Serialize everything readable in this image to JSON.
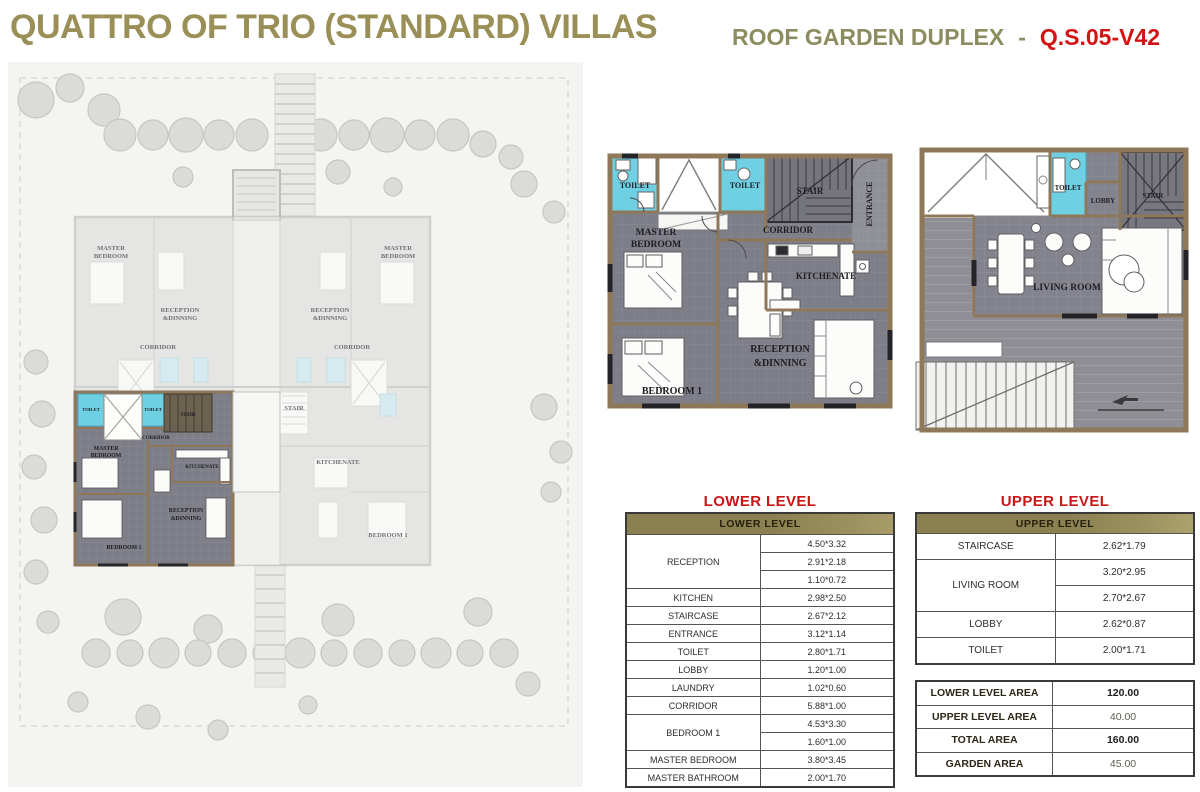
{
  "header": {
    "title": "QUATTRO OF TRIO (STANDARD) VILLAS",
    "subtitle": "ROOF GARDEN DUPLEX",
    "separator": "-",
    "unit_code": "Q.S.05-V42"
  },
  "colors": {
    "title_gold": "#9A8F57",
    "subtitle_olive": "#8C8C60",
    "code_red": "#D21414",
    "section_title_red": "#C91616",
    "table_header_olive": "#8B8150",
    "area_table_olive": "#ACA163",
    "toilet_cyan": "#6FCFE3",
    "floor_gray": "#7E7E88",
    "wall_tan": "#8F785A"
  },
  "site_plan": {
    "labels": {
      "master_line1": "MASTER",
      "master_line2": "BEDROOM",
      "bedroom1": "BEDROOM 1",
      "reception_line1": "RECEPTION",
      "reception_line2": "&DINNING",
      "kitchenate": "KITCHENATE",
      "corridor": "CORRIDOR",
      "stair": "STAIR",
      "toilet": "TOILET",
      "entrance": "ENTRANCE"
    }
  },
  "lower_plan": {
    "labels": {
      "toilet_left": "TOILET",
      "toilet_mid": "TOILET",
      "stair": "STAIR",
      "entrance": "ENTRANCE",
      "corridor": "CORRIDOR",
      "master_line1": "MASTER",
      "master_line2": "BEDROOM",
      "kitchenate": "KITCHENATE",
      "reception_line1": "RECEPTION",
      "reception_line2": "&DINNING",
      "bedroom1": "BEDROOM 1"
    }
  },
  "upper_plan": {
    "labels": {
      "toilet": "TOILET",
      "lobby": "LOBBY",
      "stair": "STAIR",
      "living_room": "LIVING ROOM"
    }
  },
  "lower_table": {
    "title": "LOWER LEVEL",
    "header": "LOWER LEVEL",
    "rows": [
      {
        "label": "RECEPTION",
        "values": [
          "4.50*3.32",
          "2.91*2.18",
          "1.10*0.72"
        ]
      },
      {
        "label": "KITCHEN",
        "values": [
          "2.98*2.50"
        ]
      },
      {
        "label": "STAIRCASE",
        "values": [
          "2.67*2.12"
        ]
      },
      {
        "label": "ENTRANCE",
        "values": [
          "3.12*1.14"
        ]
      },
      {
        "label": "TOILET",
        "values": [
          "2.80*1.71"
        ]
      },
      {
        "label": "LOBBY",
        "values": [
          "1.20*1.00"
        ]
      },
      {
        "label": "LAUNDRY",
        "values": [
          "1.02*0.60"
        ]
      },
      {
        "label": "CORRIDOR",
        "values": [
          "5.88*1.00"
        ]
      },
      {
        "label": "BEDROOM 1",
        "values": [
          "4.53*3.30",
          "1.60*1.00"
        ]
      },
      {
        "label": "MASTER BEDROOM",
        "values": [
          "3.80*3.45"
        ]
      },
      {
        "label": "MASTER BATHROOM",
        "values": [
          "2.00*1.70"
        ]
      }
    ]
  },
  "upper_table": {
    "title": "UPPER LEVEL",
    "header": "UPPER LEVEL",
    "rows": [
      {
        "label": "STAIRCASE",
        "values": [
          "2.62*1.79"
        ]
      },
      {
        "label": "LIVING ROOM",
        "values": [
          "3.20*2.95",
          "2.70*2.67"
        ]
      },
      {
        "label": "LOBBY",
        "values": [
          "2.62*0.87"
        ]
      },
      {
        "label": "TOILET",
        "values": [
          "2.00*1.71"
        ]
      }
    ]
  },
  "area_table": {
    "rows": [
      {
        "label": "LOWER LEVEL AREA",
        "value": "120.00"
      },
      {
        "label": "UPPER LEVEL AREA",
        "value": "40.00"
      },
      {
        "label": "TOTAL AREA",
        "value": "160.00"
      },
      {
        "label": "GARDEN AREA",
        "value": "45.00"
      }
    ]
  }
}
